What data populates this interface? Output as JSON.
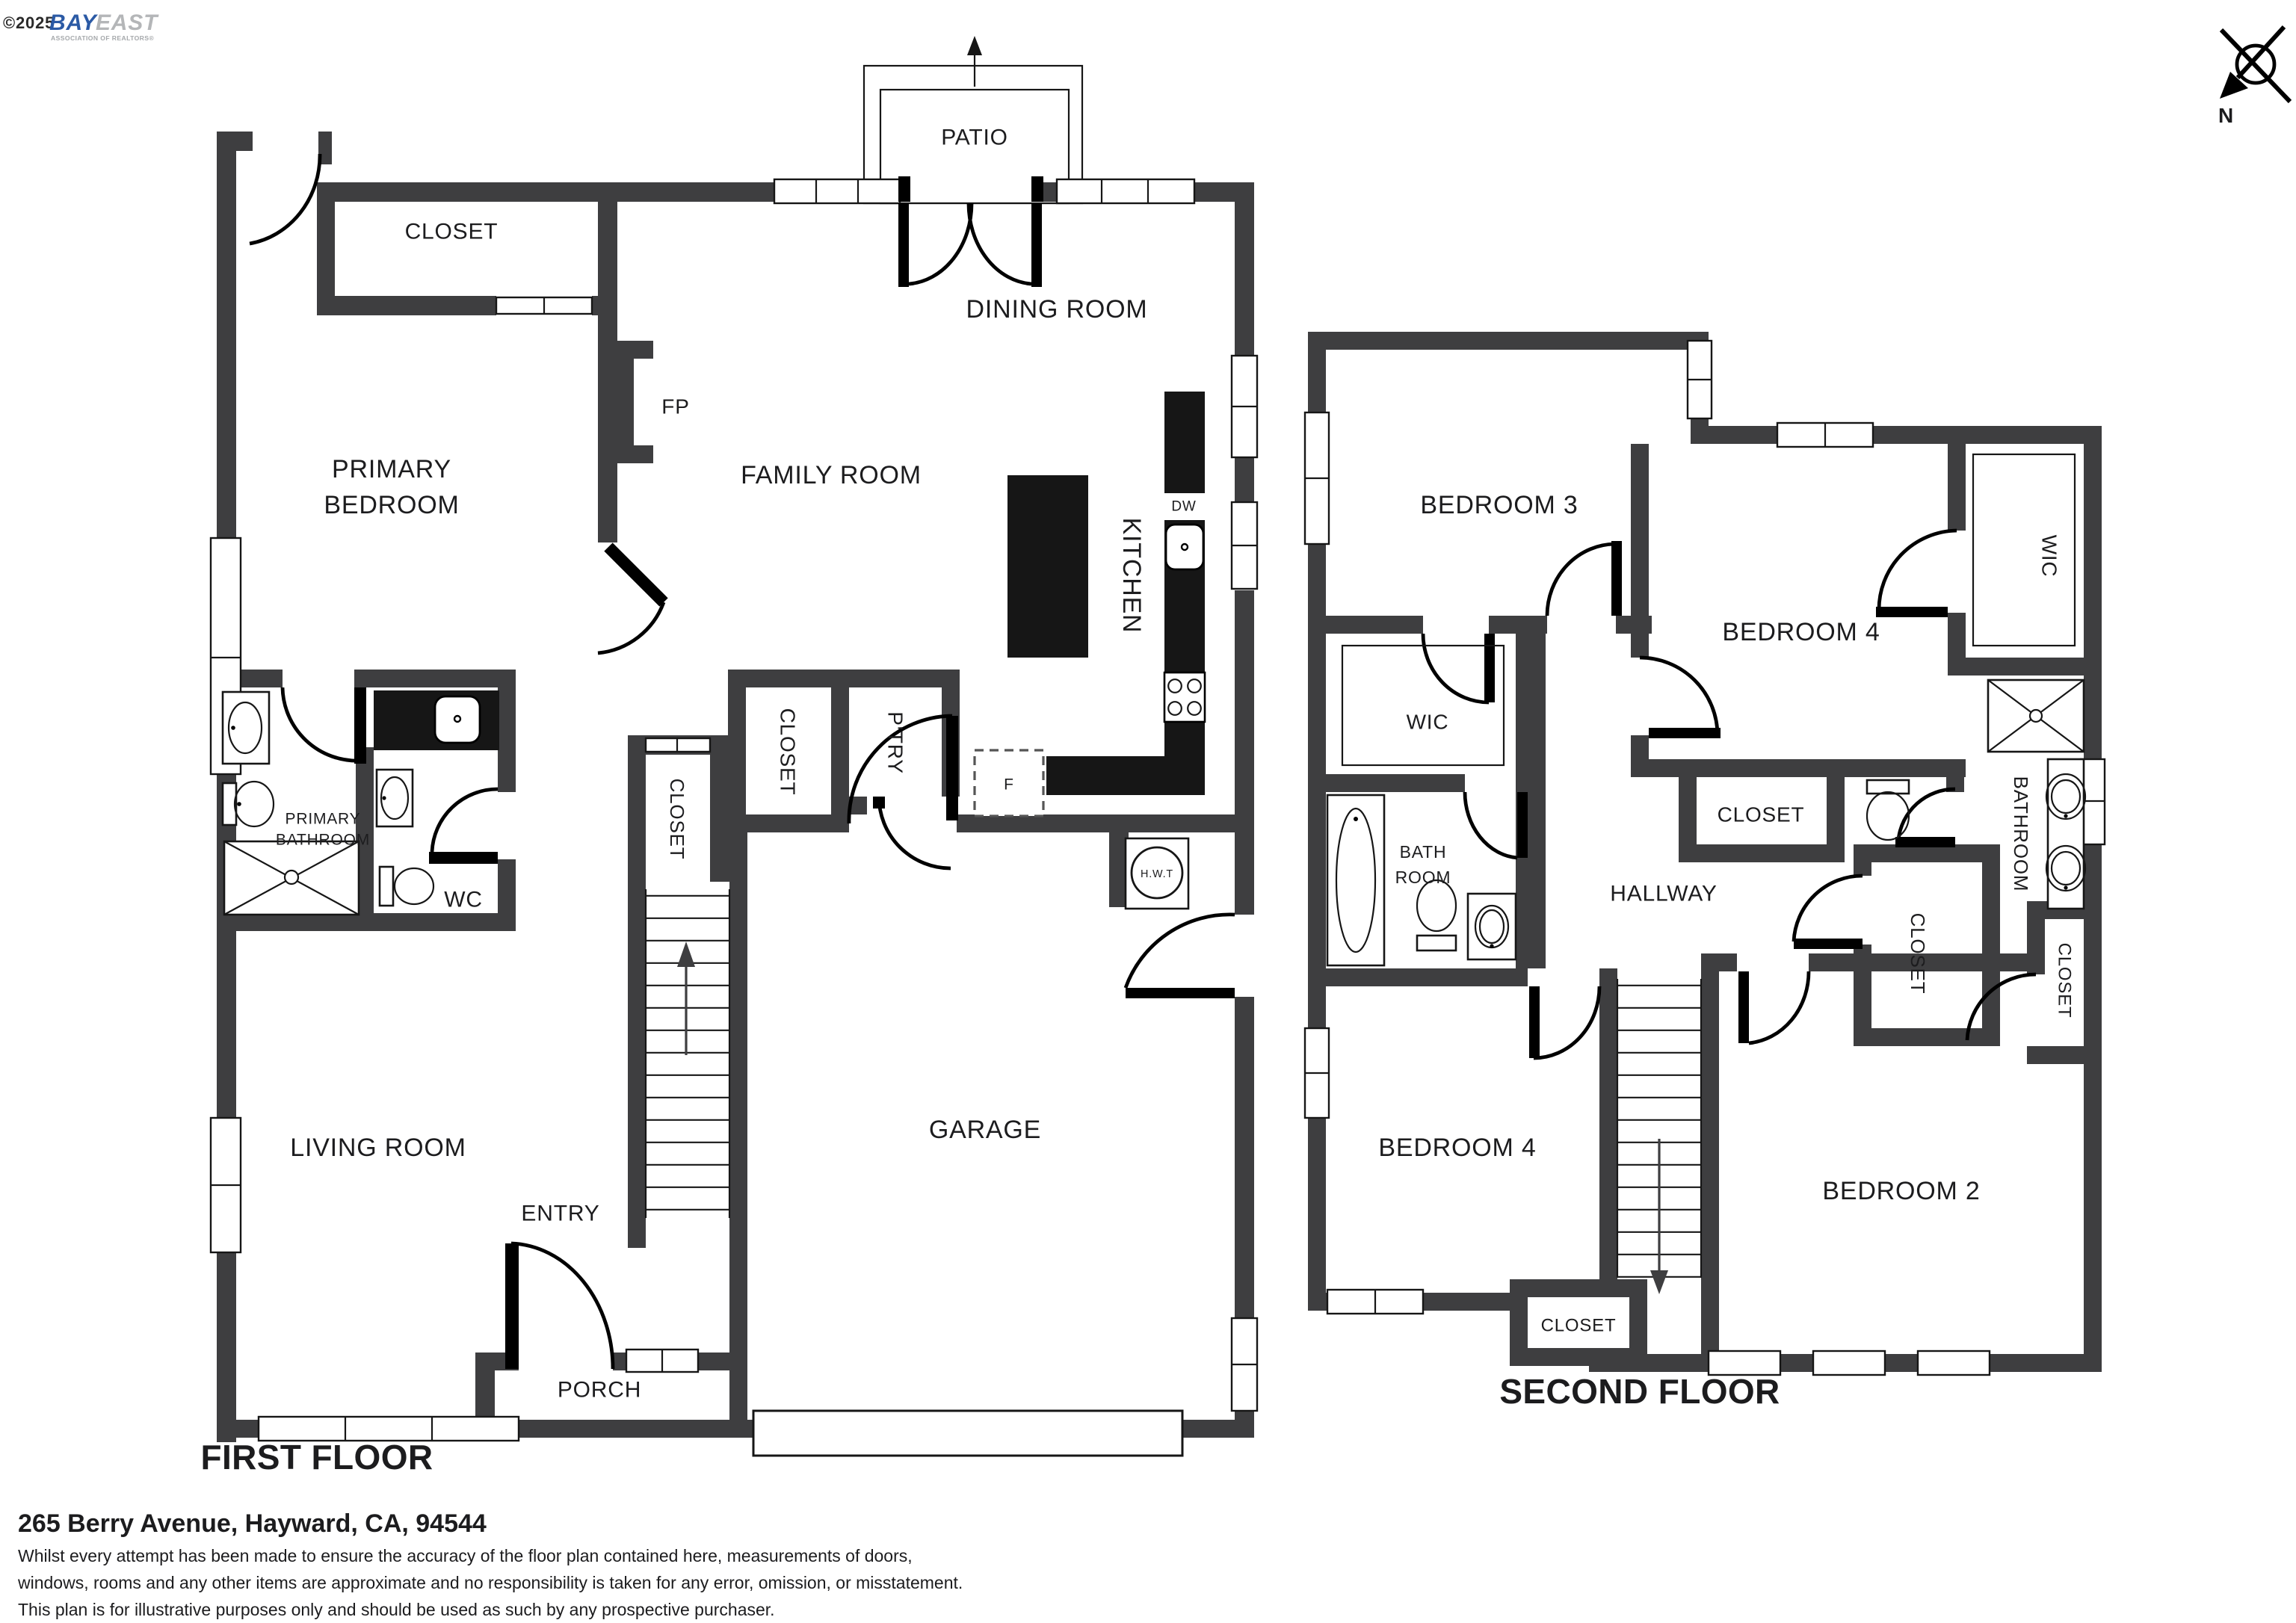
{
  "branding": {
    "copyright": "©2025",
    "logo_primary": "BAY",
    "logo_secondary": "EAST",
    "tagline": "ASSOCIATION OF REALTORS®"
  },
  "compass": {
    "north": "N"
  },
  "first_floor": {
    "title": "FIRST FLOOR",
    "labels": {
      "patio": "PATIO",
      "closet_primary": "CLOSET",
      "dining": "DINING ROOM",
      "primary_line1": "PRIMARY",
      "primary_line2": "BEDROOM",
      "fireplace": "FP",
      "family": "FAMILY ROOM",
      "kitchen": "KITCHEN",
      "dishwasher": "DW",
      "fridge": "F",
      "closet_stairs": "CLOSET",
      "closet_hall": "CLOSET",
      "pantry": "P'TRY",
      "bath_line1": "PRIMARY",
      "bath_line2": "BATHROOM",
      "wc": "WC",
      "water_heater": "H.W.T",
      "living": "LIVING ROOM",
      "entry": "ENTRY",
      "porch": "PORCH",
      "garage": "GARAGE"
    }
  },
  "second_floor": {
    "title": "SECOND FLOOR",
    "labels": {
      "bedroom3": "BEDROOM 3",
      "bedroom4_top": "BEDROOM 4",
      "wic_right": "WIC",
      "wic_left": "WIC",
      "closet_top": "CLOSET",
      "bath_line1": "BATH",
      "bath_line2": "ROOM",
      "hallway": "HALLWAY",
      "closet_mid": "CLOSET",
      "bathroom_main": "BATHROOM",
      "closet_far_right": "CLOSET",
      "bedroom4_bottom": "BEDROOM 4",
      "bedroom2": "BEDROOM 2",
      "closet_bottom": "CLOSET"
    }
  },
  "footer": {
    "address": "265 Berry Avenue, Hayward, CA, 94544",
    "disclaimer": [
      "Whilst every attempt has been made to ensure the accuracy of the floor plan contained here, measurements of doors,",
      "windows, rooms and any other items are approximate and no responsibility is taken for any error, omission, or misstatement.",
      "This plan is for illustrative purposes only and should be used as such by any prospective purchaser."
    ]
  }
}
